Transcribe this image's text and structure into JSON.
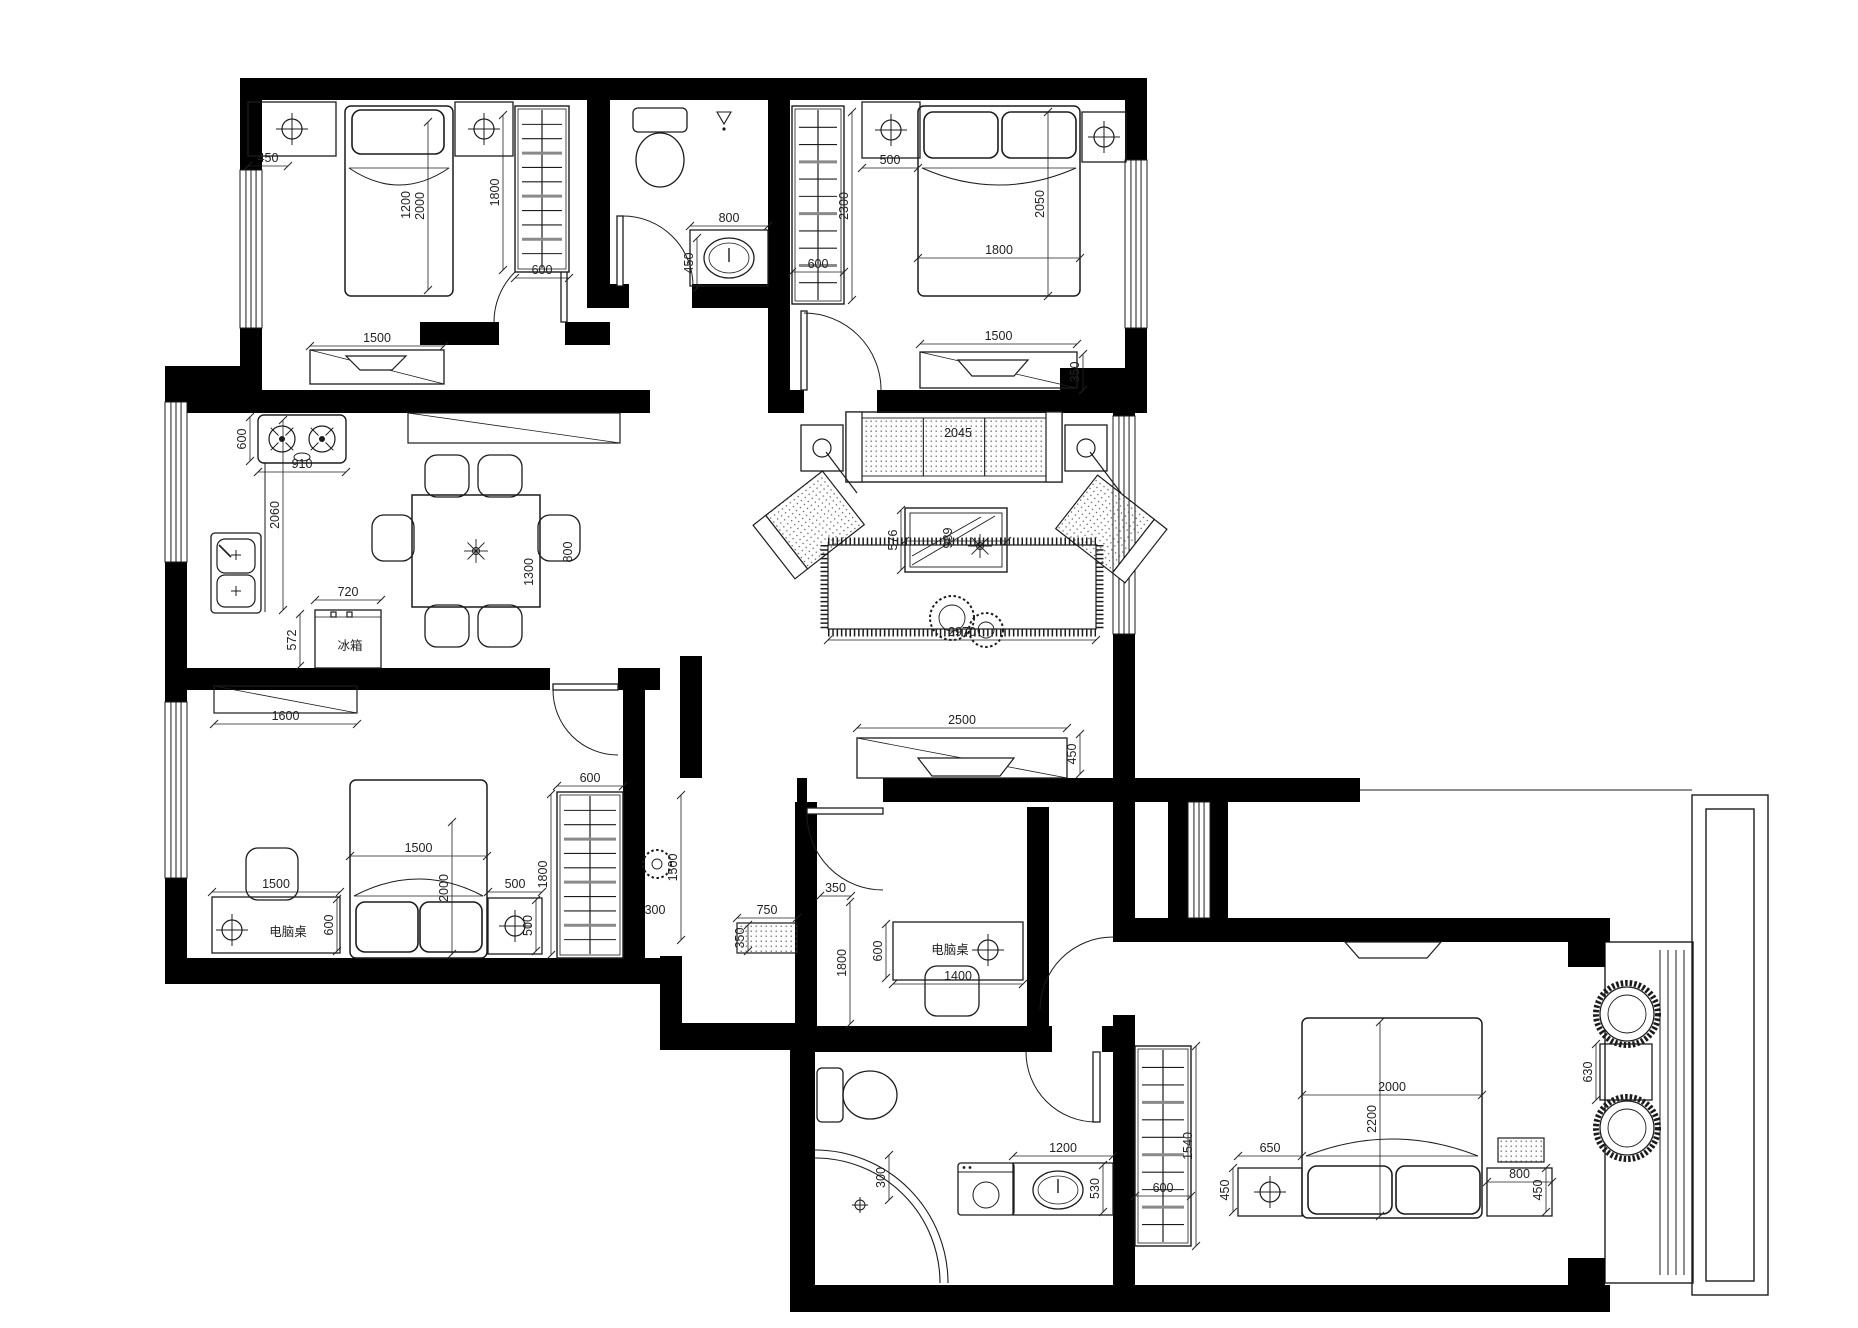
{
  "title": "apartment-floor-plan",
  "colors": {
    "wall": "#000000",
    "line": "#1c1c1c",
    "dim": "#222222",
    "bg": "#ffffff",
    "slat": "#8a8a8a"
  },
  "canvas": {
    "w": 1858,
    "h": 1328
  },
  "walls": [
    [
      240,
      78,
      907,
      22
    ],
    [
      240,
      100,
      22,
      70
    ],
    [
      240,
      328,
      22,
      62
    ],
    [
      1125,
      100,
      22,
      60
    ],
    [
      1125,
      328,
      22,
      64
    ],
    [
      587,
      100,
      23,
      208
    ],
    [
      587,
      284,
      42,
      24
    ],
    [
      692,
      284,
      78,
      24
    ],
    [
      768,
      100,
      22,
      313
    ],
    [
      420,
      322,
      79,
      23
    ],
    [
      565,
      322,
      45,
      23
    ],
    [
      165,
      366,
      97,
      24
    ],
    [
      165,
      390,
      22,
      12
    ],
    [
      165,
      562,
      22,
      140
    ],
    [
      165,
      878,
      22,
      104
    ],
    [
      165,
      390,
      485,
      23
    ],
    [
      790,
      390,
      14,
      23
    ],
    [
      877,
      390,
      270,
      23
    ],
    [
      1060,
      368,
      87,
      24
    ],
    [
      1113,
      390,
      22,
      26
    ],
    [
      1113,
      634,
      22,
      308
    ],
    [
      1113,
      1015,
      22,
      297
    ],
    [
      165,
      958,
      517,
      26
    ],
    [
      660,
      956,
      22,
      94
    ],
    [
      660,
      1023,
      140,
      27
    ],
    [
      623,
      690,
      22,
      294
    ],
    [
      795,
      802,
      22,
      250
    ],
    [
      797,
      778,
      10,
      24
    ],
    [
      883,
      778,
      342,
      24
    ],
    [
      1027,
      807,
      22,
      245
    ],
    [
      795,
      1026,
      257,
      26
    ],
    [
      1102,
      1026,
      33,
      26
    ],
    [
      790,
      1048,
      25,
      264
    ],
    [
      790,
      1285,
      345,
      27
    ],
    [
      1135,
      1285,
      475,
      27
    ],
    [
      1113,
      918,
      497,
      24
    ],
    [
      1168,
      802,
      20,
      116
    ],
    [
      1210,
      802,
      18,
      116
    ],
    [
      1225,
      778,
      135,
      24
    ],
    [
      165,
      668,
      385,
      22
    ],
    [
      618,
      668,
      42,
      22
    ],
    [
      680,
      656,
      22,
      122
    ],
    [
      1568,
      942,
      37,
      25
    ],
    [
      1568,
      1258,
      37,
      27
    ]
  ],
  "windows": [
    [
      240,
      170,
      22,
      158
    ],
    [
      1125,
      160,
      22,
      168
    ],
    [
      165,
      402,
      22,
      160
    ],
    [
      165,
      702,
      22,
      176
    ],
    [
      1113,
      416,
      22,
      218
    ],
    [
      1188,
      802,
      22,
      116
    ]
  ],
  "doors": {
    "leaves": [
      [
        561,
        252,
        6,
        70
      ],
      [
        617,
        216,
        6,
        70
      ],
      [
        801,
        311,
        6,
        79
      ],
      [
        553,
        684,
        65,
        6
      ],
      [
        807,
        808,
        76,
        6
      ],
      [
        1093,
        1052,
        7,
        70
      ]
    ],
    "arcs": [
      "M 564,252 A 70 70 0 0 0 494,322",
      "M 623,216 A 70 70 0 0 1 693,286",
      "M 804,313 A 77 77 0 0 1 881,390",
      "M 553,690 A 65 65 0 0 0 618,755",
      "M 807,814 A 76 76 0 0 0 883,890",
      "M 1026,1052 A 70 70 0 0 0 1096,1122",
      "M 1113,937 A 73 73 0 0 0 1040,1010"
    ]
  },
  "lines": [
    [
      265,
      463,
      265,
      612
    ],
    [
      1360,
      790,
      1692,
      790
    ]
  ],
  "frames": {
    "rects": [
      [
        1605,
        942,
        88,
        341
      ],
      [
        1692,
        795,
        76,
        500
      ],
      [
        1706,
        809,
        48,
        472
      ]
    ],
    "vlines": [
      [
        1660,
        950,
        1660,
        1275
      ],
      [
        1668,
        950,
        1668,
        1275
      ],
      [
        1676,
        950,
        1676,
        1275
      ],
      [
        1684,
        950,
        1684,
        1275
      ]
    ]
  },
  "furniture": {
    "beds": [
      {
        "x": 345,
        "y": 106,
        "w": 108,
        "h": 190,
        "head": "top",
        "pillows": [
          [
            352,
            110,
            92,
            44
          ]
        ]
      },
      {
        "x": 918,
        "y": 106,
        "w": 162,
        "h": 190,
        "head": "top",
        "pillows": [
          [
            924,
            112,
            74,
            46
          ],
          [
            1002,
            112,
            74,
            46
          ]
        ]
      },
      {
        "x": 350,
        "y": 780,
        "w": 137,
        "h": 178,
        "head": "bottom",
        "pillows": [
          [
            356,
            902,
            62,
            50
          ],
          [
            420,
            902,
            62,
            50
          ]
        ]
      },
      {
        "x": 1302,
        "y": 1018,
        "w": 180,
        "h": 200,
        "head": "bottom",
        "pillows": [
          [
            1308,
            1166,
            84,
            48
          ],
          [
            1396,
            1166,
            84,
            48
          ]
        ]
      }
    ],
    "wardrobes": [
      {
        "x": 515,
        "y": 106,
        "w": 54,
        "h": 166
      },
      {
        "x": 792,
        "y": 106,
        "w": 52,
        "h": 198
      },
      {
        "x": 557,
        "y": 792,
        "w": 66,
        "h": 166
      },
      {
        "x": 1135,
        "y": 1046,
        "w": 56,
        "h": 200
      }
    ],
    "nightstands": [
      [
        248,
        102,
        88,
        54
      ],
      [
        455,
        102,
        58,
        54
      ],
      [
        862,
        102,
        58,
        56
      ],
      [
        1082,
        112,
        44,
        50
      ],
      [
        488,
        898,
        54,
        56
      ],
      [
        1238,
        1168,
        64,
        48
      ],
      [
        1487,
        1168,
        65,
        48
      ]
    ],
    "lamps": [
      [
        292,
        129
      ],
      [
        484,
        129
      ],
      [
        891,
        130
      ],
      [
        1104,
        137
      ],
      [
        232,
        930
      ],
      [
        515,
        926
      ],
      [
        988,
        950
      ],
      [
        1270,
        1192
      ]
    ],
    "dressers": [
      {
        "x": 310,
        "y": 350,
        "w": 134,
        "h": 34,
        "tv": [
          346,
          356,
          60,
          14
        ]
      },
      {
        "x": 920,
        "y": 352,
        "w": 157,
        "h": 36,
        "tv": [
          958,
          360,
          70,
          16
        ]
      },
      {
        "x": 857,
        "y": 738,
        "w": 210,
        "h": 40,
        "tv": [
          918,
          758,
          96,
          18
        ]
      }
    ],
    "shelves": [
      [
        408,
        413,
        212,
        30
      ],
      [
        214,
        686,
        143,
        27
      ]
    ],
    "desks": [
      [
        893,
        922,
        130,
        58
      ],
      [
        212,
        897,
        128,
        56
      ]
    ],
    "stove": {
      "x": 258,
      "y": 415,
      "w": 88,
      "h": 48
    },
    "ksink": {
      "x": 211,
      "y": 533,
      "w": 50,
      "h": 80
    },
    "fridge": {
      "x": 315,
      "y": 610,
      "w": 66,
      "h": 58
    },
    "table": {
      "x": 412,
      "y": 495,
      "w": 128,
      "h": 112
    },
    "chairs": [
      [
        425,
        455,
        44,
        42
      ],
      [
        478,
        455,
        44,
        42
      ],
      [
        425,
        605,
        44,
        42
      ],
      [
        478,
        605,
        44,
        42
      ],
      [
        372,
        515,
        42,
        46
      ],
      [
        538,
        515,
        42,
        46
      ],
      [
        925,
        966,
        54,
        50
      ],
      [
        246,
        848,
        52,
        52
      ]
    ],
    "sofa": {
      "x": 846,
      "y": 412,
      "w": 216,
      "h": 70
    },
    "sidetables": [
      [
        801,
        425,
        42,
        46
      ],
      [
        1065,
        425,
        42,
        46
      ]
    ],
    "armchairs": [
      {
        "cx": 815,
        "cy": 520,
        "rot": -38,
        "back": "left"
      },
      {
        "cx": 1105,
        "cy": 524,
        "rot": 38,
        "back": "right"
      }
    ],
    "coffee": {
      "x": 905,
      "y": 508,
      "w": 102,
      "h": 64
    },
    "rug": {
      "x": 828,
      "y": 545,
      "w": 268,
      "h": 84
    },
    "plants": [
      [
        952,
        618,
        22
      ],
      [
        986,
        630,
        17
      ],
      [
        657,
        864,
        14
      ]
    ],
    "flowers": [
      [
        476,
        551
      ],
      [
        980,
        546
      ]
    ],
    "tvs": [
      [
        1345,
        942,
        96,
        16
      ]
    ],
    "bench": [
      737,
      923,
      60,
      30
    ],
    "mat": [
      1498,
      1138,
      46,
      24
    ],
    "washer": {
      "x": 958,
      "y": 1163,
      "w": 56,
      "h": 52
    },
    "vanity": {
      "x": 1013,
      "y": 1163,
      "w": 100,
      "h": 52
    },
    "sink1": {
      "x": 690,
      "y": 230,
      "w": 78,
      "h": 56
    },
    "toilets": [
      {
        "tank": [
          633,
          108,
          54,
          24
        ],
        "cx": 660,
        "cy": 160,
        "rx": 24,
        "ry": 27
      },
      {
        "tank": [
          817,
          1068,
          26,
          54
        ],
        "cx": 870,
        "cy": 1095,
        "rx": 27,
        "ry": 24
      }
    ],
    "showerhead": [
      724,
      112
    ],
    "shower": [
      "M 815,1150 A 133 133 0 0 1 948,1283",
      "M 815,1158 A 125 125 0 0 1 940,1283"
    ],
    "drain": [
      860,
      1205
    ],
    "roundchairs": [
      [
        1627,
        1014,
        27
      ],
      [
        1627,
        1128,
        27
      ]
    ],
    "baytable": [
      1600,
      1044,
      52,
      56
    ]
  },
  "dims": [
    [
      248,
      166,
      288,
      166,
      "450"
    ],
    [
      428,
      122,
      428,
      290,
      "2000"
    ],
    [
      503,
      115,
      503,
      270,
      "1800"
    ],
    [
      515,
      278,
      569,
      278,
      "600"
    ],
    [
      310,
      346,
      444,
      346,
      "1500"
    ],
    [
      690,
      226,
      768,
      226,
      "800"
    ],
    [
      697,
      238,
      697,
      288,
      "450"
    ],
    [
      792,
      272,
      844,
      272,
      "600"
    ],
    [
      852,
      112,
      852,
      300,
      "2300"
    ],
    [
      862,
      168,
      918,
      168,
      "500"
    ],
    [
      918,
      258,
      1080,
      258,
      "1800"
    ],
    [
      1048,
      112,
      1048,
      296,
      "2050"
    ],
    [
      920,
      344,
      1077,
      344,
      "1500"
    ],
    [
      1083,
      354,
      1083,
      390,
      "350"
    ],
    [
      250,
      417,
      250,
      461,
      "600"
    ],
    [
      258,
      472,
      346,
      472,
      "910"
    ],
    [
      283,
      420,
      283,
      610,
      "2060"
    ],
    [
      315,
      600,
      381,
      600,
      "720"
    ],
    [
      300,
      614,
      300,
      666,
      "572"
    ],
    [
      214,
      724,
      357,
      724,
      "1600"
    ],
    [
      905,
      541,
      1007,
      541,
      ""
    ],
    [
      901,
      510,
      901,
      570,
      "576"
    ],
    [
      828,
      640,
      1096,
      640,
      "2970"
    ],
    [
      857,
      728,
      1067,
      728,
      "2500"
    ],
    [
      1080,
      734,
      1080,
      774,
      "450"
    ],
    [
      350,
      856,
      487,
      856,
      "1500"
    ],
    [
      452,
      822,
      452,
      954,
      "2000"
    ],
    [
      488,
      892,
      542,
      892,
      "500"
    ],
    [
      536,
      900,
      536,
      951,
      "500"
    ],
    [
      557,
      786,
      623,
      786,
      "600"
    ],
    [
      551,
      794,
      551,
      955,
      "1800"
    ],
    [
      212,
      892,
      340,
      892,
      "1500"
    ],
    [
      337,
      899,
      337,
      951,
      "600"
    ],
    [
      681,
      795,
      681,
      940,
      "1500"
    ],
    [
      737,
      918,
      797,
      918,
      "750"
    ],
    [
      748,
      925,
      748,
      951,
      "350"
    ],
    [
      820,
      896,
      851,
      896,
      "350"
    ],
    [
      850,
      902,
      850,
      1024,
      "1800"
    ],
    [
      886,
      924,
      886,
      978,
      "600"
    ],
    [
      893,
      984,
      1023,
      984,
      "1400"
    ],
    [
      1238,
      1156,
      1302,
      1156,
      "650"
    ],
    [
      1233,
      1168,
      1233,
      1212,
      "450"
    ],
    [
      1487,
      1182,
      1552,
      1182,
      "800"
    ],
    [
      1546,
      1168,
      1546,
      1212,
      "450"
    ],
    [
      1302,
      1095,
      1482,
      1095,
      "2000"
    ],
    [
      1380,
      1022,
      1380,
      1216,
      "2200"
    ],
    [
      1013,
      1156,
      1113,
      1156,
      "1200"
    ],
    [
      1103,
      1165,
      1103,
      1212,
      "530"
    ],
    [
      1135,
      1196,
      1191,
      1196,
      "600"
    ],
    [
      1196,
      1046,
      1196,
      1246,
      "1540"
    ],
    [
      1596,
      1044,
      1596,
      1100,
      "630"
    ],
    [
      889,
      1155,
      889,
      1200,
      "300"
    ]
  ],
  "labels": [
    [
      "1200",
      410,
      205,
      90
    ],
    [
      "2045",
      958,
      437,
      0
    ],
    [
      "989",
      952,
      538,
      90
    ],
    [
      "1300",
      533,
      572,
      90
    ],
    [
      "800",
      572,
      552,
      90
    ],
    [
      "冰箱",
      350,
      650,
      0
    ],
    [
      "电脑桌",
      288,
      936,
      0
    ],
    [
      "电脑桌",
      950,
      954,
      0
    ],
    [
      "300",
      655,
      914,
      0
    ]
  ]
}
